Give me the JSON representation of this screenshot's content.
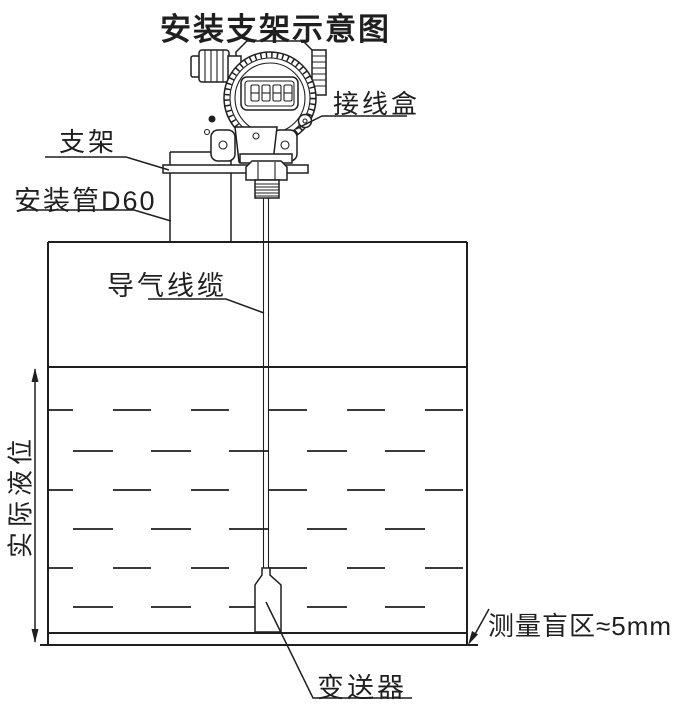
{
  "title": "安装支架示意图",
  "labels": {
    "junction_box": "接线盒",
    "bracket": "支架",
    "mounting_pipe": "安装管D60",
    "air_cable": "导气线缆",
    "actual_level": "实际液位",
    "blind_zone": "测量盲区≈5mm",
    "transmitter": "变送器"
  },
  "sensor_display": {
    "value": "8888"
  },
  "colors": {
    "line": "#1f1f1f",
    "background": "#ffffff"
  }
}
